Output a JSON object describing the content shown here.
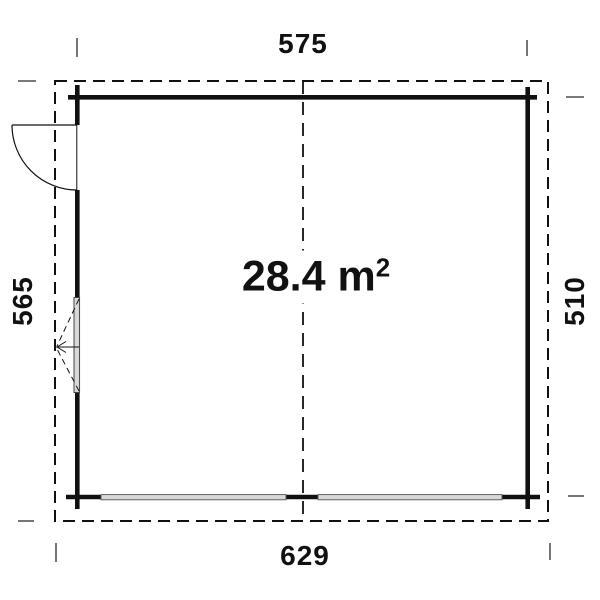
{
  "plan": {
    "area": {
      "value": "28.4 m",
      "superscript": "2"
    },
    "dimensions": {
      "top": "575",
      "bottom": "629",
      "left": "565",
      "right": "510"
    },
    "colors": {
      "line": "#111111",
      "wall": "#111111",
      "panel_fill": "#d8d8d8",
      "panel_edge": "#555555",
      "tick": "#666666",
      "background": "#ffffff"
    },
    "symbols": [
      "door-swing",
      "tilt-window",
      "garage-door-panels",
      "roof-overhang-outline",
      "center-axis-line"
    ]
  }
}
